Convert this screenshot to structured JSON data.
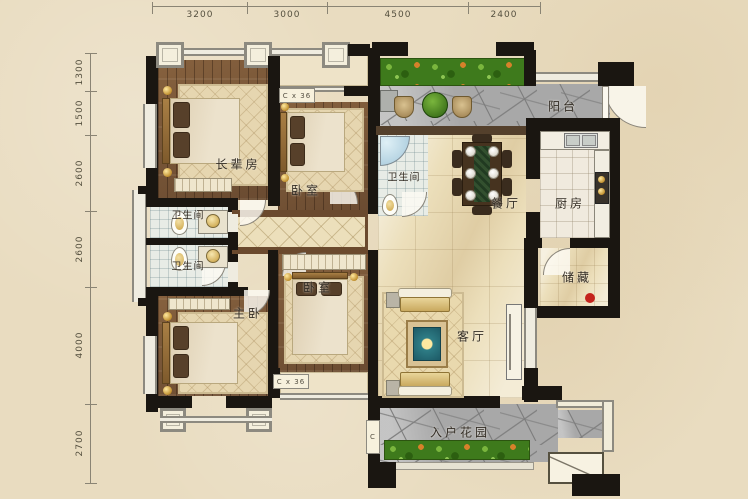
{
  "plan": {
    "dims_top": [
      "3200",
      "3000",
      "4500",
      "2400"
    ],
    "dims_left": [
      "1300",
      "1500",
      "2600",
      "2600",
      "4000",
      "2700"
    ],
    "rooms": {
      "elder_room": "长辈房",
      "bedroom_top": "卧室",
      "bedroom_mid": "卧室",
      "master_bedroom": "主卧",
      "bathroom_1": "卫生间",
      "bathroom_2": "卫生间",
      "bathroom_3": "卫生间",
      "dining": "餐厅",
      "kitchen": "厨房",
      "storage": "储藏",
      "living": "客厅",
      "balcony": "阳台",
      "entry_garden": "入户花园"
    },
    "tags": {
      "bay_window_top": "C x 36",
      "bay_window_bottom": "C x 36",
      "meter": "C"
    },
    "colors": {
      "background": "#e9dcc0",
      "wall": "#1a1611",
      "wood": "#7b5a3d",
      "marble": "#ecdfbb",
      "stone": "#a8a8a8",
      "plants": "#3e7a1c",
      "marker": "#c4231c"
    }
  }
}
